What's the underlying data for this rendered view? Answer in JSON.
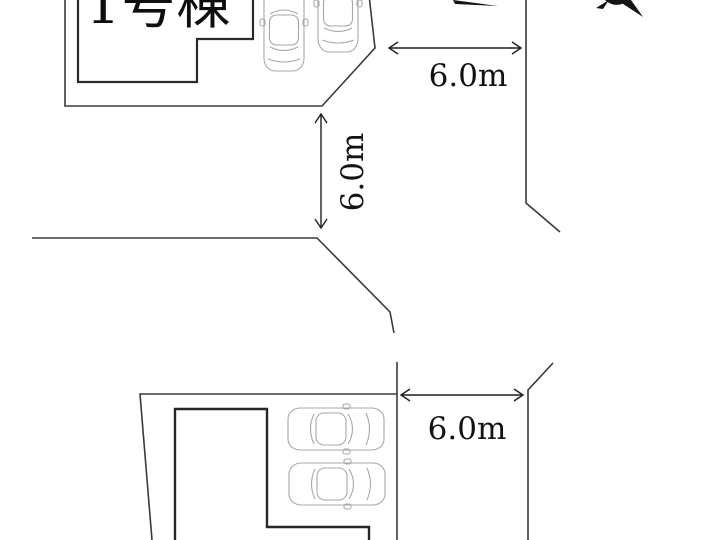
{
  "plan": {
    "building_label": "1号棟",
    "dimensions": {
      "west_road": "6.0m",
      "north_road": "6.0m",
      "south_road": "6.0m"
    },
    "colors": {
      "background": "#ffffff",
      "boundary_line": "#3a3a3a",
      "building_line": "#2a2a2a",
      "dimension_line": "#1f1f1f",
      "car_outline": "#a8a8a8",
      "text": "#121212"
    },
    "icons": {
      "north_arrow": "north-arrow-icon (black wedges, cut off at top edge)",
      "car": "car-top-view-icon (light gray outline), 2 vertical in lot 1, 2 horizontal in lot 2"
    },
    "car_count": 4
  }
}
